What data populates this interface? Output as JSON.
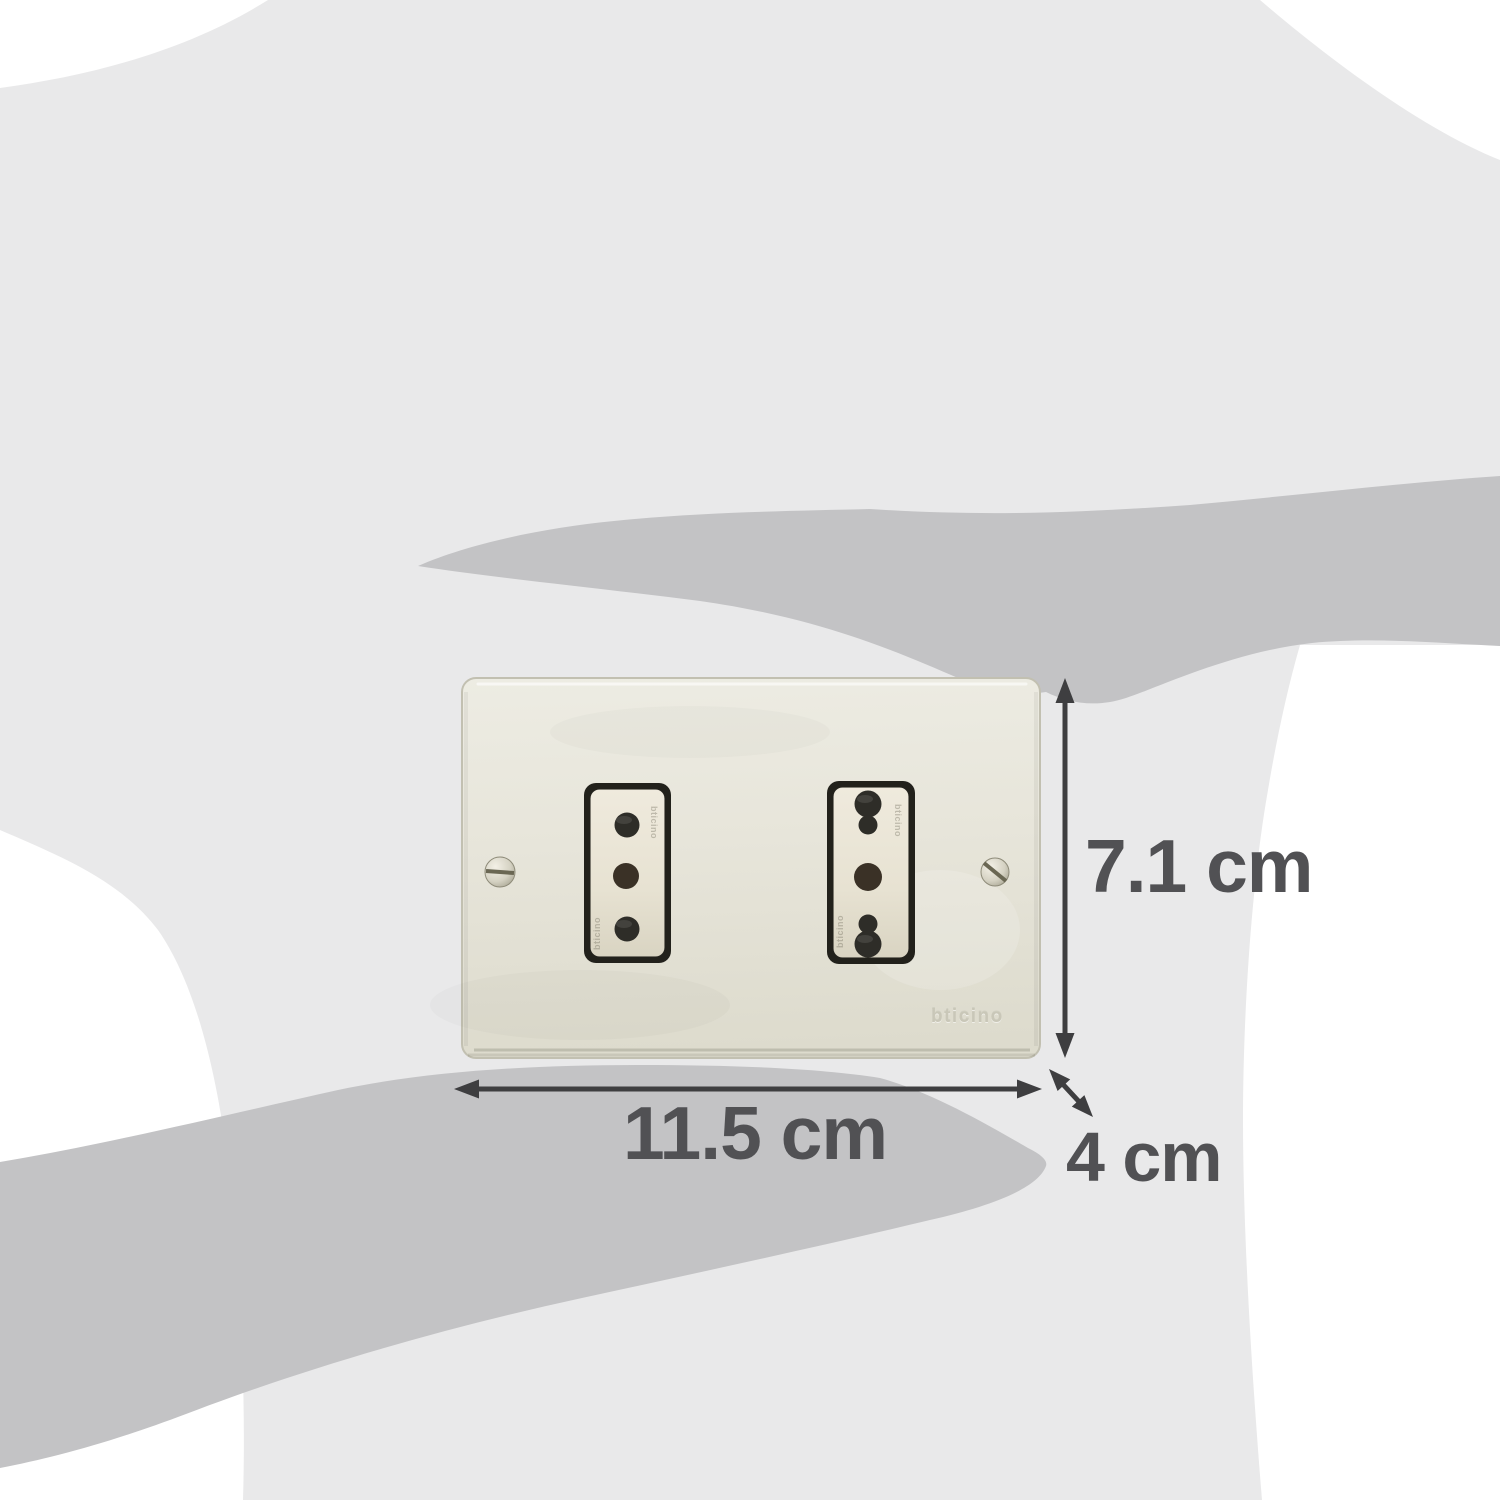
{
  "annotations": {
    "width_label": "11.5 cm",
    "height_label": "7.1 cm",
    "depth_label": "4 cm"
  },
  "product": {
    "brand_embossed": "bticino"
  },
  "icons": {
    "silhouette": "human-body-and-hands-scale-silhouette",
    "left_socket": "italian-type-l-3-pin-socket",
    "right_socket": "italian-bipasso-3-pin-socket",
    "screw": "slotted-screw-icon",
    "arrows": "double-headed-dimension-arrow"
  },
  "colors": {
    "background": "#ffffff",
    "body_silhouette": "#e9e9ea",
    "hand_silhouette": "#c3c3c5",
    "plate_face": "#e7e5da",
    "plate_edge": "#c2c0b1",
    "socket_recess": "#22211b",
    "socket_face": "#e8e3d4",
    "socket_hole": "#2e2d28",
    "socket_hole_bronze": "#3a3126",
    "annotation_text": "#515154",
    "annotation_arrow": "#3e3e40",
    "brand_emboss": "#c9c7b8"
  }
}
